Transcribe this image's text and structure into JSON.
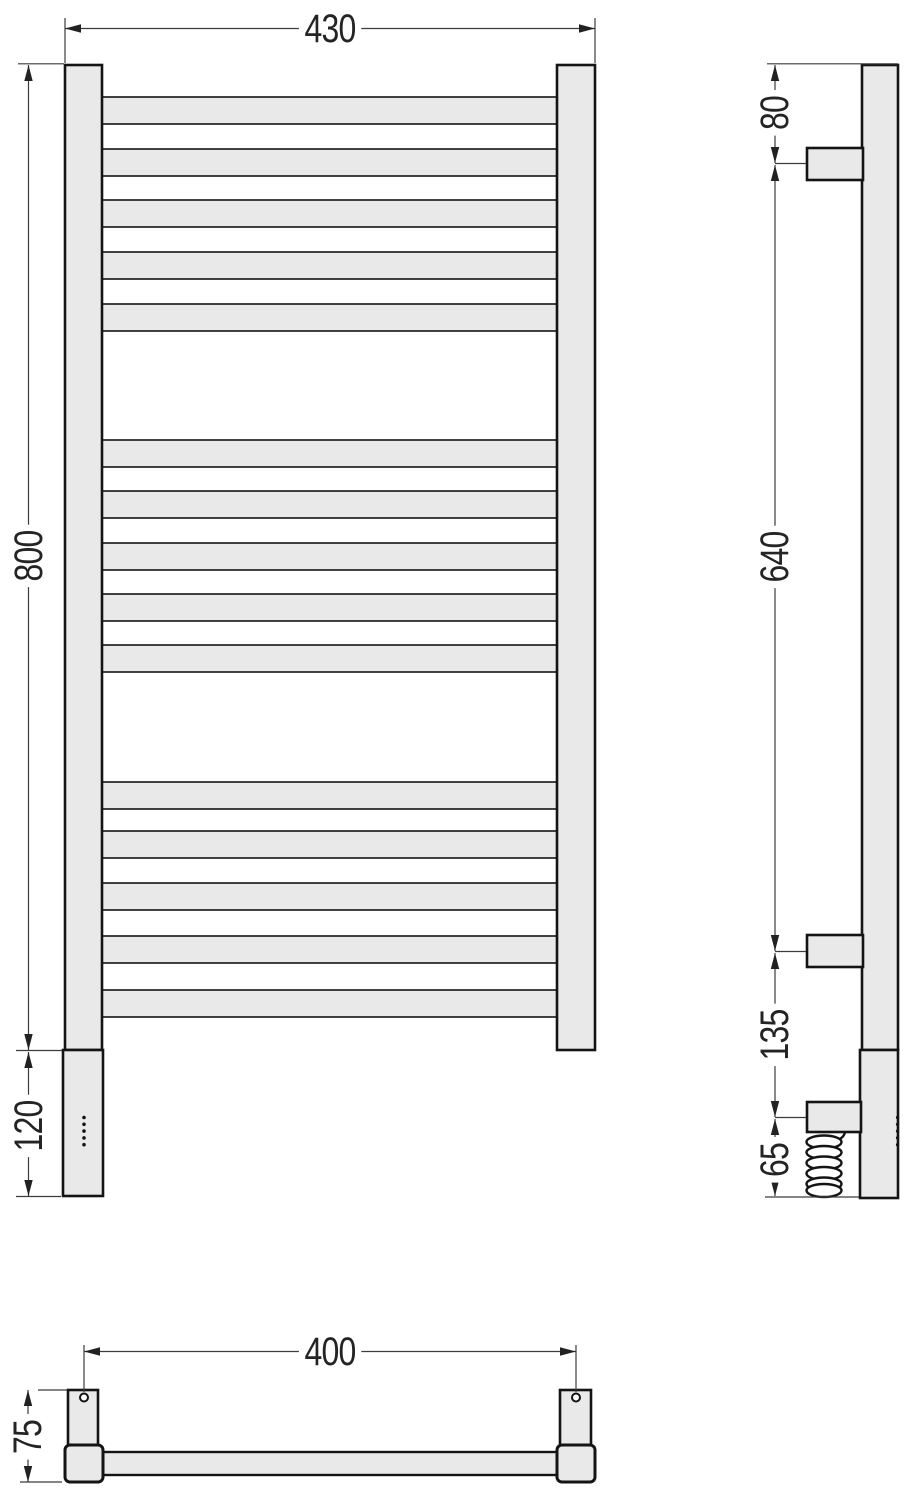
{
  "views": {
    "front": {
      "dim_width": "430",
      "dim_height": "800",
      "dim_bottom_section": "120"
    },
    "side": {
      "dim_top_to_bracket": "80",
      "dim_bracket_span": "640",
      "dim_bracket_to_connection": "135",
      "dim_cable_drop": "65"
    },
    "bottom": {
      "dim_mounting_centers": "400",
      "dim_depth": "75"
    }
  },
  "colors": {
    "body_fill": "#e9e9e9",
    "outline": "#141414",
    "dimension_line": "#3c3c3c",
    "text": "#242424",
    "background": "#ffffff"
  }
}
